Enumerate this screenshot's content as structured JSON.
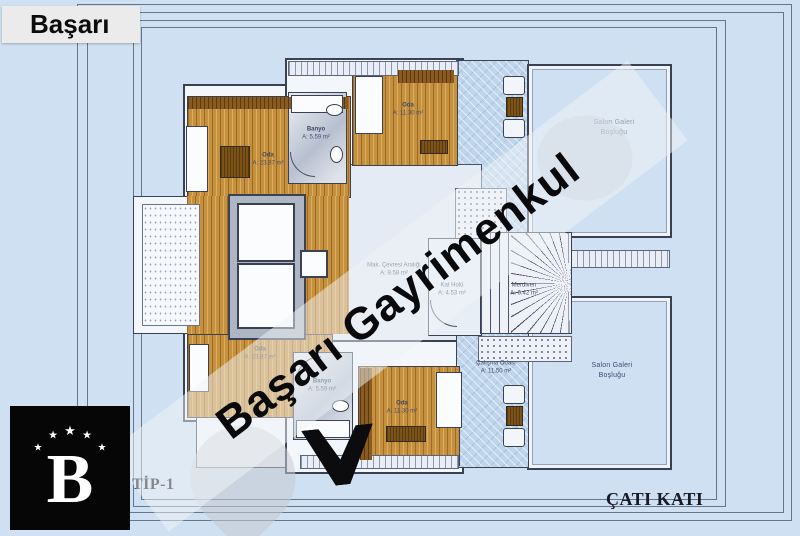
{
  "header": {
    "brand": "Başarı"
  },
  "watermark": {
    "text": "Başarı Gayrimenkul"
  },
  "logo": {
    "letter": "B",
    "star": "★"
  },
  "footer": {
    "type_label": "TİP-1",
    "floor_label": "ÇATI KATI"
  },
  "plan": {
    "rooms": {
      "oda_top_left": {
        "name": "Oda",
        "area": "A: 23.87 m²"
      },
      "banyo_top": {
        "name": "Banyo",
        "area": "A: 5.59 m²"
      },
      "oda_top": {
        "name": "Oda",
        "area": "A: 11.30 m²"
      },
      "salon_galeri_top": {
        "name": "Salon Galeri",
        "area": "Boşluğu"
      },
      "mak_cevresi": {
        "name": "Mak. Çevresi Aralığı",
        "area": "A: 9.58 m²"
      },
      "kat_holu": {
        "name": "Kat Holü",
        "area": "A: 4.53 m²"
      },
      "merdiven": {
        "name": "Merdiven",
        "area": "A: 6.42 m²"
      },
      "oda_bottom_left": {
        "name": "Oda",
        "area": "A: 23.87 m²"
      },
      "banyo_bottom": {
        "name": "Banyo",
        "area": "A: 5.59 m²"
      },
      "oda_bottom": {
        "name": "Oda",
        "area": "A: 11.30 m²"
      },
      "calisma_odasi": {
        "name": "Çalışma Odası",
        "area": "A: 11.50 m²"
      },
      "salon_galeri_bottom": {
        "name": "Salon Galeri",
        "area": "Boşluğu"
      }
    }
  },
  "colors": {
    "background": "#cfe0f2",
    "wood": "#c6913f",
    "terrace_blue": "#bed5ec",
    "wall": "#3a4152",
    "watermark_text": "#0a0a0c",
    "logo_bg": "#060606"
  }
}
